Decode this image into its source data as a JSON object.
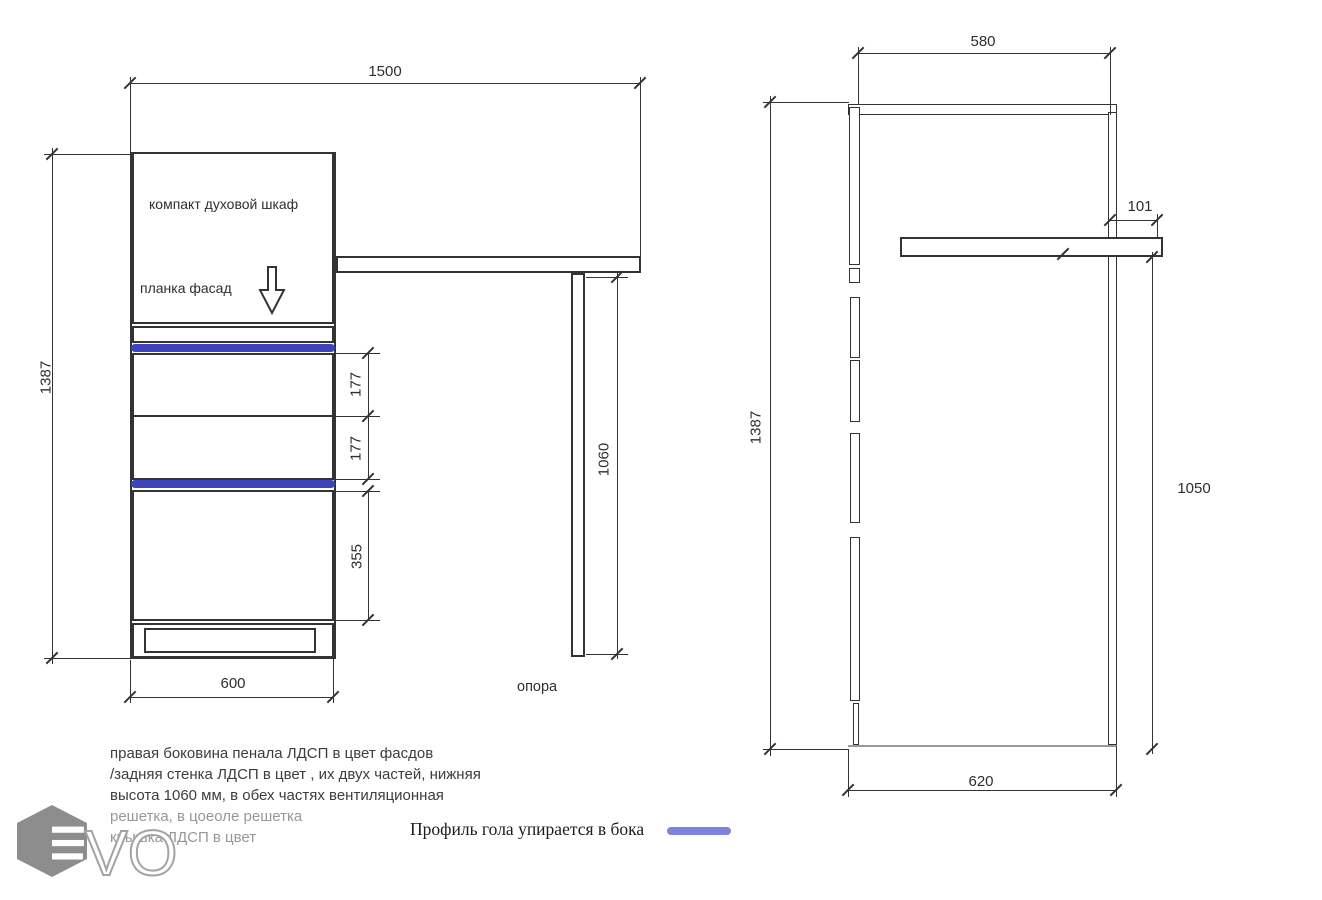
{
  "front_view": {
    "labels": {
      "oven": "компакт духовой шкаф",
      "plank": "планка фасад",
      "support": "опора"
    },
    "dims": {
      "total_width": "1500",
      "total_height": "1387",
      "drawer_1": "177",
      "drawer_2": "177",
      "lower_door": "355",
      "base_width": "600",
      "support_height": "1060"
    }
  },
  "side_view": {
    "dims": {
      "top_depth": "580",
      "worktop_overhang": "101",
      "total_height": "1387",
      "right_height": "1050",
      "bottom_depth": "620"
    }
  },
  "notes": {
    "lines": [
      "правая боковина пенала ЛДСП в цвет фасдов",
      "/задняя стенка ЛДСП  в цвет , их двух частей, нижняя",
      "высота 1060 мм, в обех частях вентиляционная",
      "решетка, в цоеоле решетка",
      "крышка ЛДСП  в цвет"
    ]
  },
  "legend": {
    "text": "Профиль гола упирается в бока"
  },
  "logo": {
    "text": "VO"
  },
  "colors": {
    "line": "#333333",
    "profile_blue": "#3c43bb",
    "legend_blue": "#7d83d9",
    "muted": "#979797",
    "logo_gray": "#8d8d8d"
  }
}
